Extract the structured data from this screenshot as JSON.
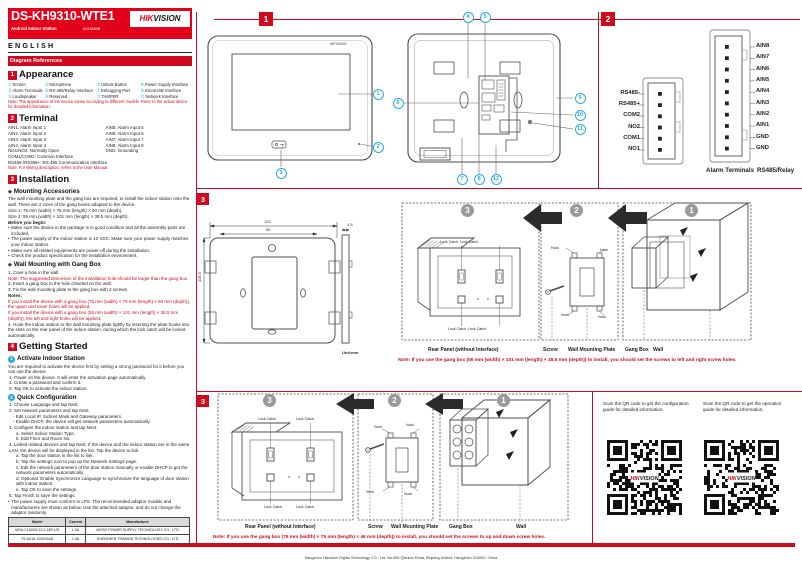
{
  "colors": {
    "brand_red": "#e2001a",
    "rule_red": "#cf0a1e",
    "callout_cyan": "#29abe2",
    "step_gray": "#9a9a9a"
  },
  "icons": {
    "diamond": "◆",
    "bullet": "•",
    "flame": "◆"
  },
  "header": {
    "model": "DS-KH9310-WTE1",
    "subtitle": "Android Indoor Station",
    "doc_code": "UD15580B",
    "brand_hik": "HIK",
    "brand_vision": "VISION",
    "language": "ENGLISH",
    "diagram_refs": "Diagram References"
  },
  "appearance": {
    "num": "1",
    "title": "Appearance",
    "items": [
      {
        "n": "①",
        "label": "Screen"
      },
      {
        "n": "②",
        "label": "Microphone"
      },
      {
        "n": "③",
        "label": "Unlock Button"
      },
      {
        "n": "④",
        "label": "Power Supply Interface"
      },
      {
        "n": "⑤",
        "label": "Alarm Terminals"
      },
      {
        "n": "⑥",
        "label": "RS-485/Relay Interface"
      },
      {
        "n": "⑦",
        "label": "Debugging Port"
      },
      {
        "n": "⑧",
        "label": "microUSB Interface"
      },
      {
        "n": "⑨",
        "label": "Loudspeaker"
      },
      {
        "n": "⑩",
        "label": "Reserved"
      },
      {
        "n": "⑪",
        "label": "TAMPER"
      },
      {
        "n": "⑫",
        "label": "Network Interface"
      }
    ],
    "note": "Note: The appearance of the device varies according to different models. Refer to the actual device for detailed information."
  },
  "terminal": {
    "num": "2",
    "title": "Terminal",
    "left": [
      "AIN1: Alarm Input 1",
      "AIN2: Alarm Input 2",
      "AIN3: Alarm Input 3",
      "AIN4: Alarm Input 4",
      "NO1/NO2: Normally Open"
    ],
    "right": [
      "AIN5: Alarm Input 5",
      "AIN6: Alarm Input 6",
      "AIN7: Alarm Input 7",
      "AIN8: Alarm Input 8",
      "GND: Grounding"
    ],
    "full": [
      "COM1/COM2: Common Interface",
      "RS485-/RS485+: RS-485 Communication Interface"
    ],
    "note": "Note: For Wiring description, refers to the User Manual."
  },
  "installation": {
    "num": "3",
    "title": "Installation",
    "sub1": "Mounting Accessories",
    "intro": "The wall mounting plate and the gang box are required, to install the indoor station onto the wall. There are 2 sizes of the gang boxes adapted to the device.",
    "size1": "Size 1: 75 mm (width) × 75 mm (length) × 60 mm (depth).",
    "size2": "Size 2: 55 mm (width) × 101 mm (length) × 38.5 mm (depth).",
    "before_title": "Before you begin:",
    "before": [
      "Make sure the device in the package is in good condition and all the assembly parts are included.",
      "The power supply of the indoor station is 12 VDC. Make sure your power supply matches your indoor station.",
      "Make sure all related equipments are power-off during the installation.",
      "Check the product specification for the installation environment."
    ],
    "sub2": "Wall Mounting with Gang Box",
    "step1": "1. Cave a hole in the wall.",
    "note1": "Note: The suggested dimension of the installation hole should be larger than the gang box.",
    "step2": "2. Insert a gang box to the hole chiseled on the wall.",
    "step3": "3. Fix the wall mounting plate to the gang box with 2 screws.",
    "notes_label": "Notes:",
    "noteA": "If you install the device with a gang box (75 mm (width) × 75 mm (length) × 60 mm (depth)), the upper and lower holes will be applied.",
    "noteB": "If you install the device with a gang box (55 mm (width) × 101 mm (length) × 38.5 mm (depth)), the left and right holes will be applied.",
    "step4": "4. Hook the indoor station to the wall mounting plate tightly by inserting the plate hooks into the slots on the rear panel of the indoor station, during which the lock catch will be locked automatically."
  },
  "getting_started": {
    "num": "4",
    "title": "Getting Started",
    "s1_num": "1",
    "s1_title": "Activate Indoor Station",
    "s1_intro": "You are required to activate the device first by setting a strong password for it before you can use the device.",
    "s1_steps": [
      "1. Power on the device. It will enter the activation page automatically.",
      "2. Create a password and confirm it.",
      "3. Tap OK to activate the indoor station."
    ],
    "s2_num": "2",
    "s2_title": "Quick Configuration",
    "q1": "1. Choose Language and tap Next.",
    "q2": "2. Set network parameters and tap Next.",
    "q2a": "- Edit Local IP, Subnet Mask and Gateway parameters.",
    "q2b": "- Enable DHCP, the device will get network parameters automatically.",
    "q3": "3. Configure the indoor station and tap Next.",
    "q3a": "a. Select Indoor Station Type.",
    "q3b": "b. Edit Floor and Room No.",
    "q4": "4. Linked related devices and tap Next. If the device and the indoor station are in the same LAN, the device will be displayed in the list. Tap the device to link.",
    "q4a": "a. Tap the door station in the list to link.",
    "q4b": "b. Tap the settings icon to pop up the Network Settings page.",
    "q4c": "c. Edit the network parameters of the door station manually or enable DHCP to get the network parameters automatically.",
    "q4d": "d. Optional: Enable Synchronize Language to synchronize the language of door station with indoor station.",
    "q4e": "e. Tap OK to save the settings.",
    "q5": "5. Tap Finish to save the settings.",
    "power_note": "The power supply must conform to LPS. The recommended adaptor models and manufacturers are shown as below. Use the attached adaptor, and do not change the adaptor randomly.",
    "table": {
      "headers": [
        "Model",
        "Current",
        "Manufacturer"
      ],
      "rows": [
        [
          "MSA-C1500IC12.0-18P-US",
          "1.5A",
          "MOSO POWER SUPPLY TECHNOLOGY CO., LTD"
        ],
        [
          "TS-A018-120015AD",
          "1.5A",
          "SHENZHEN TRANSIN TECHNOLOGIES CO., LTD"
        ]
      ]
    },
    "ref_config": "Refer to Video Intercom Network Indoor Station Configuration Guide (scan the QR code) for details.",
    "ref_operation": "Refer to Video Intercom Network Indoor Station Operation Guide (scan the QR code) for details."
  },
  "diagram_top": {
    "badge_front": "1",
    "badge_terminals": "2",
    "device_logo": "HIKVISION",
    "callouts": [
      "1",
      "2",
      "3",
      "4",
      "5",
      "6",
      "7",
      "8",
      "9",
      "10",
      "11",
      "12"
    ],
    "rs485_labels": [
      "RS485-",
      "RS485+",
      "COM2",
      "NO2",
      "COM1",
      "NO1"
    ],
    "alarm_labels": [
      "AIN8",
      "AIN7",
      "AIN6",
      "AIN5",
      "AIN4",
      "AIN3",
      "AIN2",
      "AIN1",
      "GND",
      "GND"
    ],
    "caption_alarm": "Alarm Terminals",
    "caption_rs485": "RS485/Relay"
  },
  "diagram_plate": {
    "badge": "3",
    "dim_width": "122",
    "dim_inner": "92",
    "dim_height": "105.5",
    "dim_thickness": "1.5",
    "unit": "Unit:mm"
  },
  "install_row1": {
    "steps": [
      "3",
      "2",
      "1"
    ],
    "lock_catch": "Lock Catch",
    "hook": "Hook",
    "cap_rear": "Rear Panel (without Interface)",
    "cap_screw": "Screw",
    "cap_plate": "Wall Mounting Plate",
    "cap_box": "Gang Box",
    "cap_wall": "Wall",
    "note": "Note:  If you use the gang box (55 mm (width) × 101 mm (length) × 38.5 mm (depth)) to install, you should set the screws to left and right screw holes."
  },
  "install_row2": {
    "badge": "3",
    "steps": [
      "3",
      "2",
      "1"
    ],
    "lock_catch": "Lock Catch",
    "hook": "Hook",
    "cap_rear": "Rear Panel (without Interface)",
    "cap_screw": "Screw",
    "cap_plate": "Wall Mounting Plate",
    "cap_box": "Gang Box",
    "cap_wall": "Wall",
    "note": "Note: If you use the gang box (75 mm (width) × 75 mm (length) × 46 mm (depth)) to install,  you should set the screws to up and down screw holes."
  },
  "qr_section": {
    "config_text": "Scan the QR code to get the configuration guide for detailed information.",
    "operation_text": "Scan the QR code to get the operation guide for detailed information."
  },
  "footer": {
    "address": "Hangzhou Hikvision Digital Technology CO., Ltd. No.555 Qianmo Road, Binjiang District, Hangzhou 310052, China"
  }
}
